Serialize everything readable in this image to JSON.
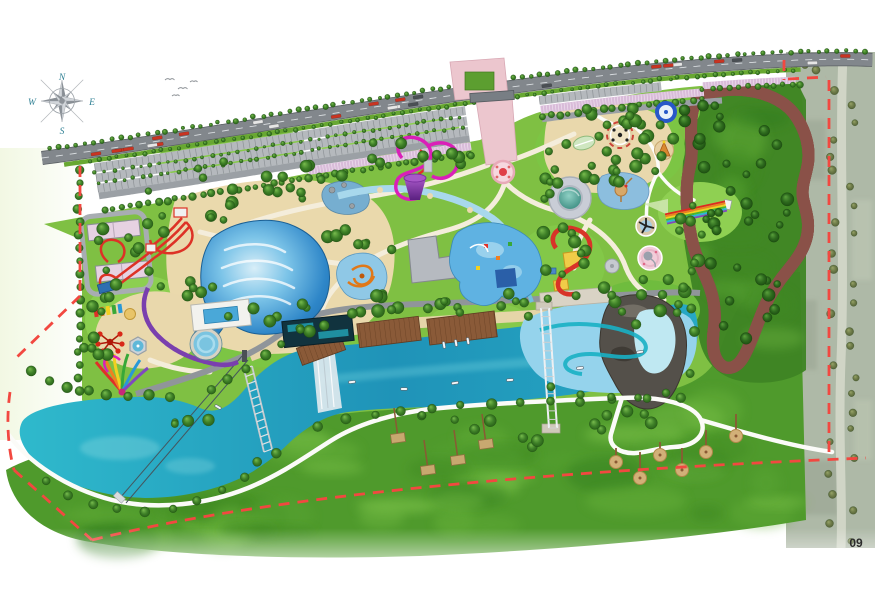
{
  "page": {
    "background": "#ffffff",
    "page_number": "09"
  },
  "compass": {
    "n": "N",
    "e": "E",
    "s": "S",
    "w": "W",
    "color": "#2e7f93"
  },
  "plan": {
    "title": "water-park-master-plan",
    "boundary_color": "#f24840",
    "water_color": "#28aac6",
    "lagoon_color": "#95d3ec",
    "sand_color": "#ead9ac",
    "lawn_color": "#7fc043",
    "meadow_color": "#4f9a2c",
    "road_color": "#82878c",
    "parking_color": "#b5b9bd",
    "pink_parking_color": "#d9bcd9",
    "plaza_color": "#ecc6ce",
    "features": [
      "compass-rose",
      "highway",
      "parking-rows",
      "entrance-plaza",
      "entrance-fountain",
      "wave-pool",
      "beach",
      "grotto-pool",
      "lazy-river",
      "kids-aqua-pool",
      "toddler-pool",
      "tornado-slide",
      "speed-slides",
      "butterfly-slide",
      "racer-track",
      "coil-slide",
      "dome-pavilion",
      "rainbow-racer-slide",
      "play-pads",
      "service-buildings",
      "river",
      "waterfall",
      "boat-docks",
      "boats",
      "pier-bridge",
      "river-bridge",
      "zipline",
      "lake",
      "lagoon",
      "rock-island",
      "lazy-river-channel",
      "loop-track",
      "meadow",
      "umbrella-decks",
      "site-boundary",
      "aerial-road"
    ]
  }
}
